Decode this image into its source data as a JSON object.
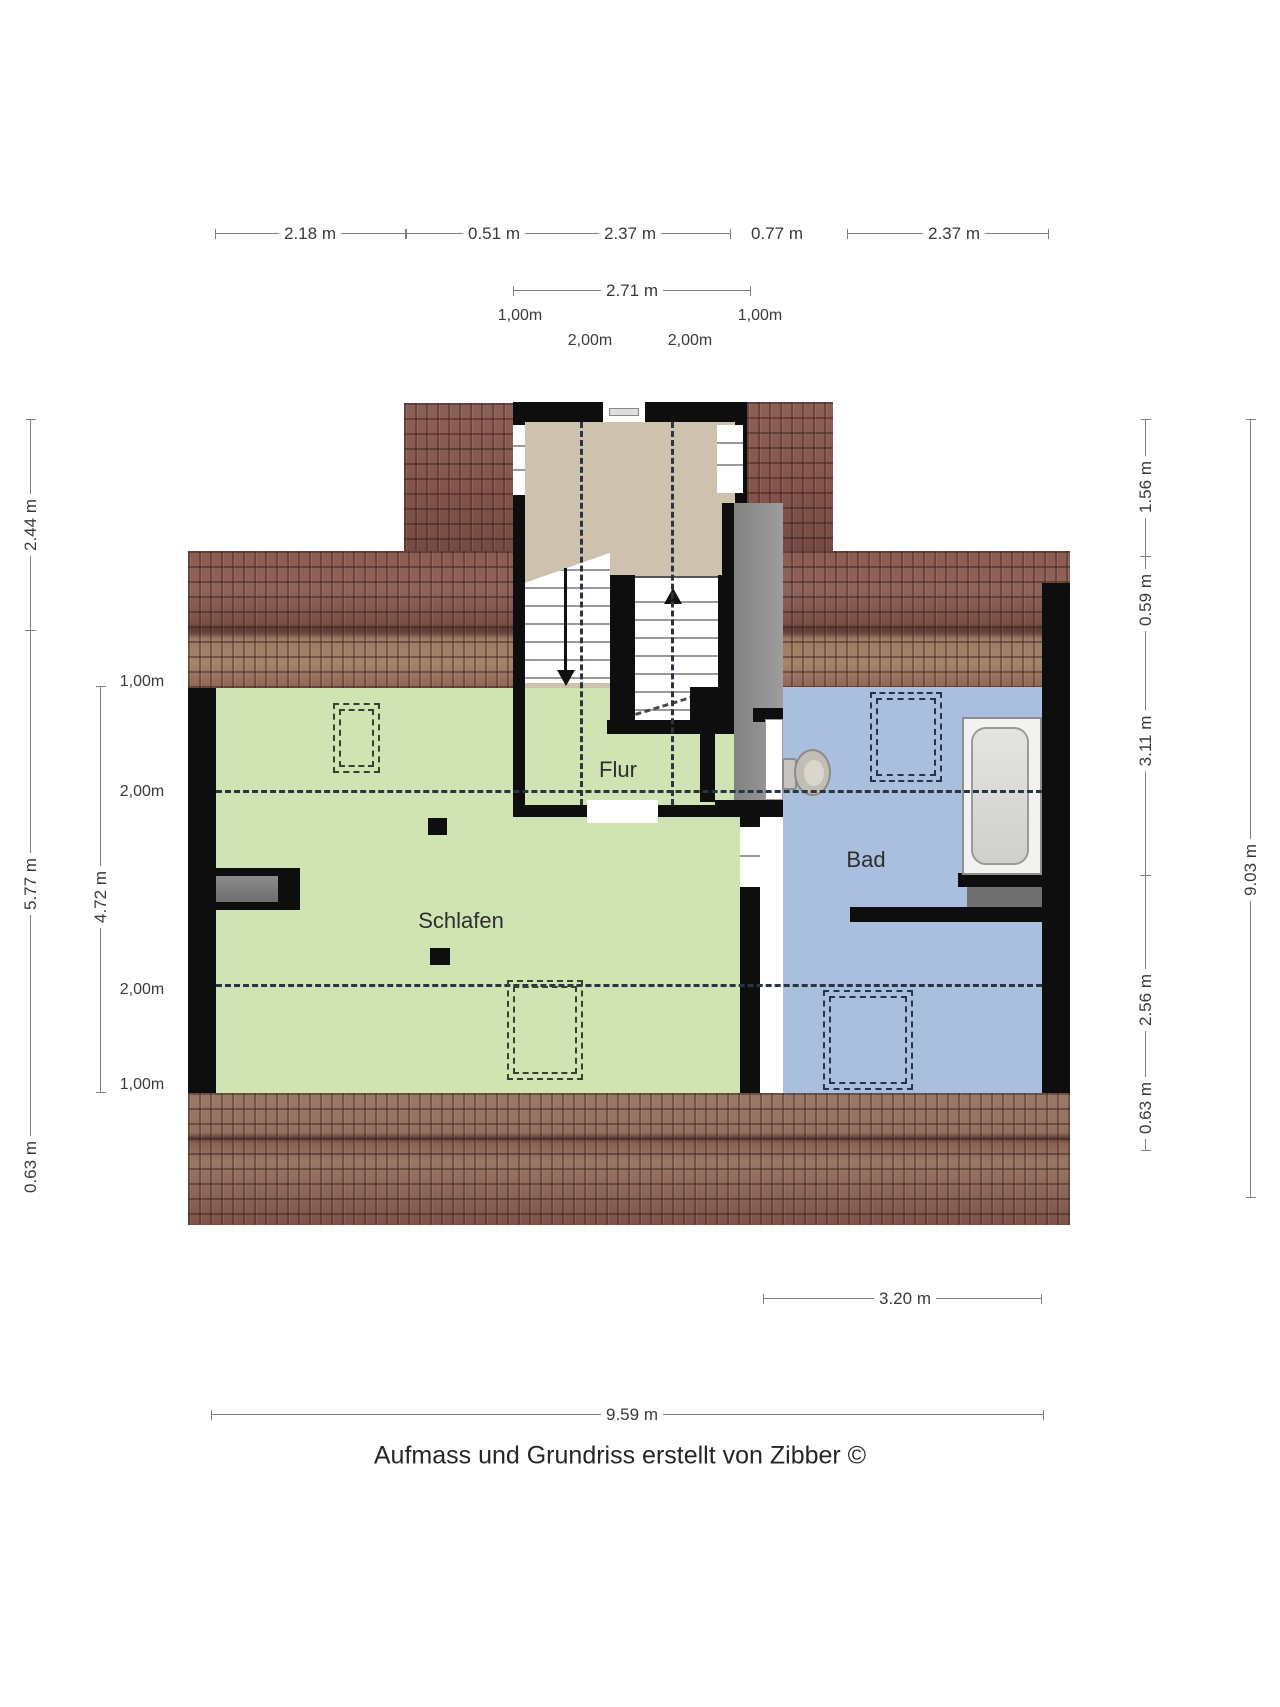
{
  "rooms": {
    "flur": "Flur",
    "schlafen": "Schlafen",
    "bad": "Bad"
  },
  "caption": "Aufmass und Grundriss erstellt von Zibber ©",
  "dims": {
    "top": [
      "2.18 m",
      "0.51 m",
      "2.37 m",
      "0.77 m",
      "2.37 m"
    ],
    "dormer_width": "2.71 m",
    "dormer_marks_outer": [
      "1,00m",
      "1,00m"
    ],
    "dormer_marks_inner": [
      "2,00m",
      "2,00m"
    ],
    "left_outer": [
      "2.44 m",
      "5.77 m",
      "0.63 m"
    ],
    "left_inner_total": "4.72 m",
    "left_inner_marks": [
      "1,00m",
      "2,00m",
      "2,00m",
      "1,00m"
    ],
    "right_inner": [
      "1.56 m",
      "0.59 m",
      "3.11 m",
      "2.56 m",
      "0.63 m"
    ],
    "right_outer": "9.03 m",
    "bottom_bad": "3.20 m",
    "bottom_total": "9.59 m"
  },
  "colors": {
    "wall": "#0e0e0e",
    "roof_tile": "#8a5c52",
    "flur": "#cec1ad",
    "schlafen": "#cfe4b2",
    "bad": "#a9bfdd",
    "low_headroom": "#8f8f8f",
    "dash": "#2a3542",
    "dim_line": "#7f7f7f"
  }
}
